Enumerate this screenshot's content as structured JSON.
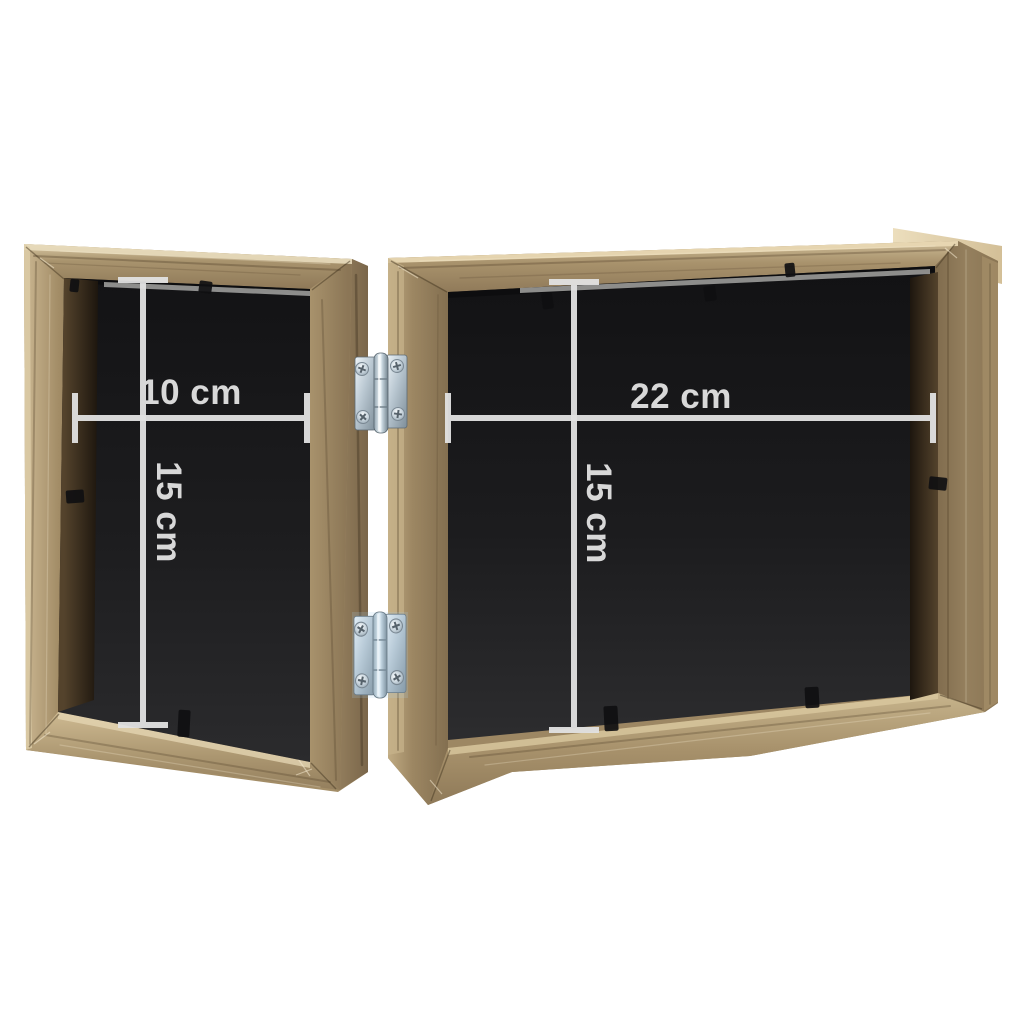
{
  "image": {
    "background": "#ffffff"
  },
  "colors": {
    "dimension_lines": "#e2e2e2",
    "label_text": "#d8d8d8",
    "clip_black": "#101012",
    "wood_light": "#cdbb96",
    "wood_mid": "#a8926c",
    "wood_dark": "#7e6a4c",
    "backing_black": "#1c1c1e",
    "hinge_steel": "#c2d2dc"
  },
  "panels": {
    "left": {
      "width_label": "10 cm",
      "height_label": "15 cm"
    },
    "right": {
      "width_label": "22 cm",
      "height_label": "15 cm"
    }
  },
  "hardware": {
    "hinge_count": 2
  }
}
